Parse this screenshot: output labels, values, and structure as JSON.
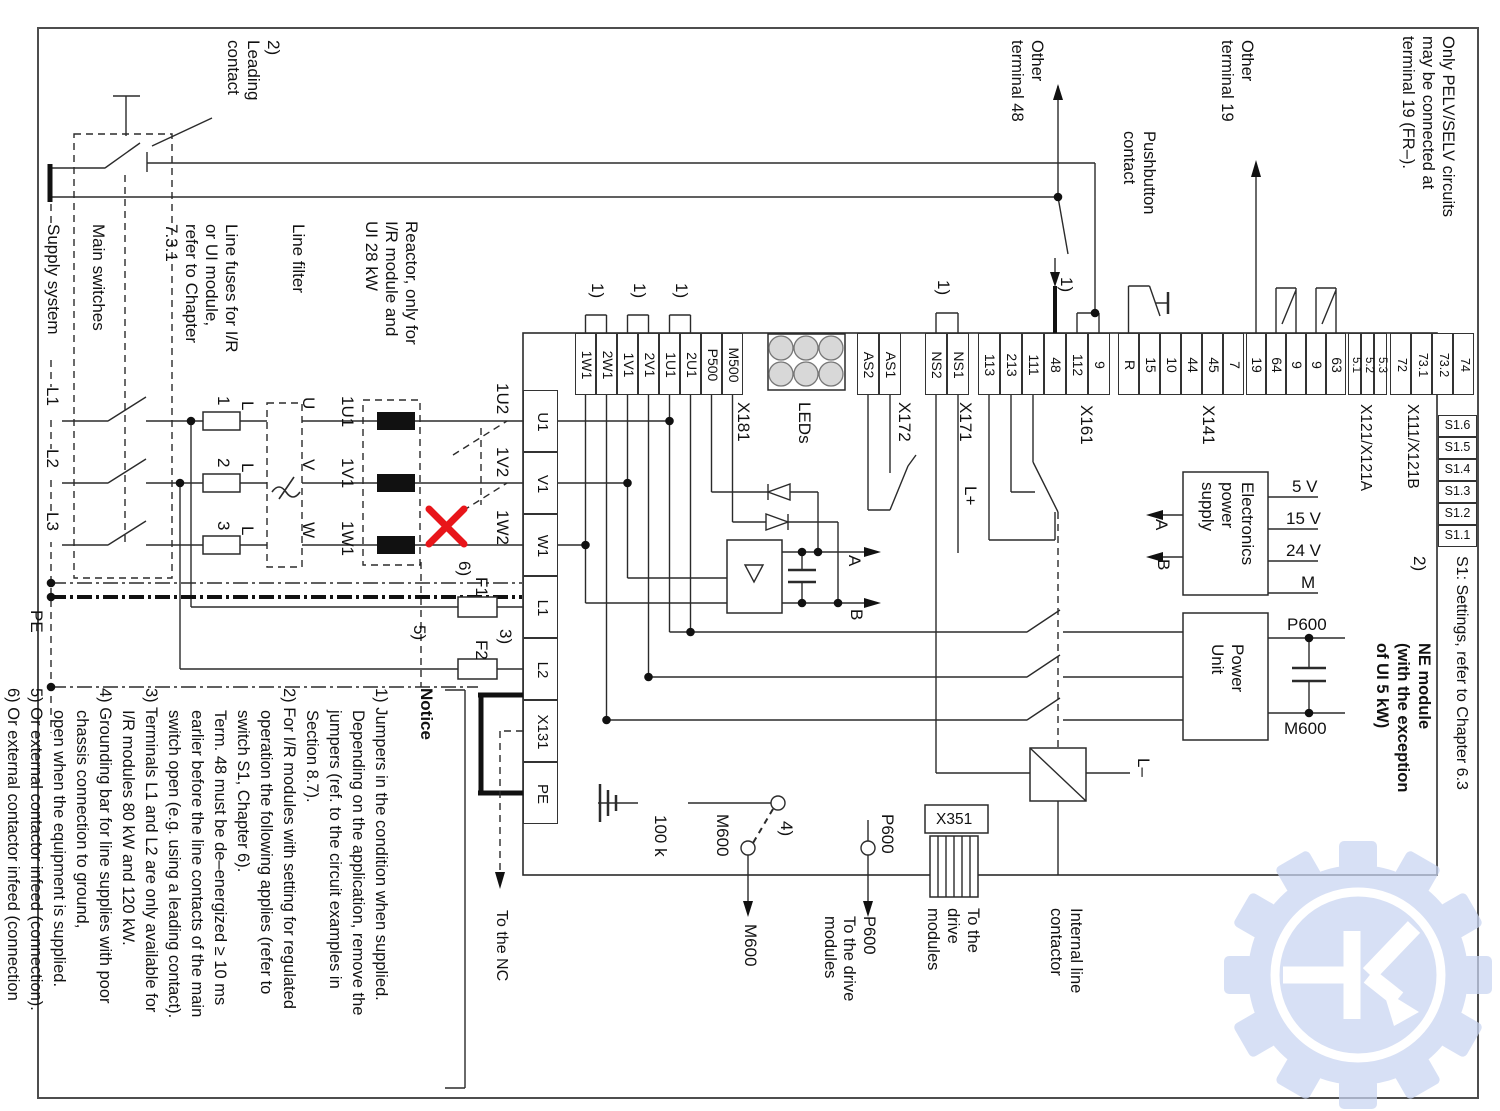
{
  "notice": {
    "header": "Notice",
    "items": [
      "1) Jumpers in the condition when supplied.\nDepending on the application, remove the\njumpers (ref. to the circuit examples in\nSection 8.7).",
      "2) For I/R modules with setting for regulated\noperation the following applies (refer to\nswitch S1, Chapter 6).\nTerm. 48 must be de–energized ≥  10 ms\nearlier before the line contacts of the main\nswitch open (e.g. using a leading contact).",
      "3) Terminals L1 and L2 are only available for\nI/R modules 80 kW and 120 kW.",
      "4) Grounding bar for line supplies with poor\nchassis connection to ground,\nopen when the equipment is supplied.",
      "5) Or external contactor infeed (connection).",
      "6) Or external contactor infeed (connection\nnot permitted)."
    ]
  },
  "s1": {
    "x": 1438,
    "y0": 415,
    "w": 39,
    "h": 22,
    "items": [
      "S1.6",
      "S1.5",
      "S1.4",
      "S1.3",
      "S1.2",
      "S1.1"
    ]
  },
  "terminal_groups": [
    {
      "name": "x181-strip",
      "x0": 575,
      "y0": 333,
      "bw": 21,
      "bh": 62,
      "items": [
        "1W1",
        "2W1",
        "1V1",
        "2V1",
        "1U1",
        "2U1",
        "P500",
        "M500"
      ],
      "fs": 14
    },
    {
      "name": "x172-strip",
      "x0": 857,
      "y0": 333,
      "bw": 22,
      "bh": 62,
      "items": [
        "AS2",
        "AS1"
      ],
      "fs": 14
    },
    {
      "name": "x171-strip",
      "x0": 925,
      "y0": 333,
      "bw": 22,
      "bh": 62,
      "items": [
        "NS2",
        "NS1"
      ],
      "fs": 14
    },
    {
      "name": "x161-strip",
      "x0": 978,
      "y0": 333,
      "bw": 22,
      "bh": 62,
      "items": [
        "113",
        "213",
        "111",
        "48",
        "112",
        "9"
      ],
      "fs": 14
    },
    {
      "name": "x141-strip",
      "x0": 1118,
      "y0": 333,
      "bw": 21,
      "bh": 62,
      "items": [
        "R",
        "15",
        "10",
        "44",
        "45",
        "7"
      ],
      "fs": 14
    },
    {
      "name": "x121a-strip",
      "x0": 1246,
      "y0": 333,
      "bw": 20,
      "bh": 62,
      "items": [
        "19",
        "64",
        "9",
        "9",
        "63"
      ],
      "fs": 14
    },
    {
      "name": "x121a2-strip",
      "x0": 1348,
      "y0": 333,
      "bw": 13,
      "bh": 62,
      "items": [
        "5.1",
        "5.2",
        "5.3"
      ],
      "fs": 11.5
    },
    {
      "name": "x111-strip",
      "x0": 1390,
      "y0": 333,
      "bw": 21,
      "bh": 62,
      "items": [
        "72",
        "73.1",
        "73.2",
        "74"
      ],
      "fs": 12.5
    },
    {
      "name": "module-left",
      "vert": true,
      "x0": 523,
      "y0": 390,
      "bw": 35,
      "bh": 62,
      "items": [
        "U1",
        "V1",
        "W1",
        "L1",
        "L2",
        "X131",
        "PE"
      ],
      "fs": 15
    }
  ],
  "labels": [
    {
      "name": "leading-contact-note",
      "text": "2)\nLeading\ncontact",
      "x": 283,
      "y": 40,
      "w": 82
    },
    {
      "name": "supply-system",
      "text": "Supply system",
      "x": 63,
      "y": 224,
      "w": 132,
      "bg": 1
    },
    {
      "name": "main-switches",
      "text": "Main switches",
      "x": 108,
      "y": 224,
      "w": 132
    },
    {
      "name": "line-fuses-note",
      "text": "Line fuses for I/R\nor UI module,\nrefer to Chapter\n7.3.1",
      "x": 241,
      "y": 224,
      "w": 160
    },
    {
      "name": "line-filter",
      "text": "Line filter",
      "x": 308,
      "y": 224,
      "w": 100
    },
    {
      "name": "reactor-note",
      "text": "Reactor, only for\nI/R module and\nUI 28 kW",
      "x": 421,
      "y": 221,
      "w": 160
    },
    {
      "name": "phase-l1",
      "text": "L1",
      "x": 62,
      "y": 387,
      "w": 30,
      "bg": 1
    },
    {
      "name": "phase-l2",
      "text": "L2",
      "x": 62,
      "y": 449,
      "w": 30,
      "bg": 1
    },
    {
      "name": "phase-l3",
      "text": "L3",
      "x": 62,
      "y": 512,
      "w": 30,
      "bg": 1
    },
    {
      "name": "pe-label",
      "text": "PE",
      "x": 46,
      "y": 610,
      "w": 34
    },
    {
      "name": "fuse-1",
      "text": "1",
      "x": 233,
      "y": 396,
      "w": 16
    },
    {
      "name": "fuse-2",
      "text": "2",
      "x": 233,
      "y": 458,
      "w": 16
    },
    {
      "name": "fuse-3",
      "text": "3",
      "x": 233,
      "y": 521,
      "w": 16
    },
    {
      "name": "fuse-l1",
      "text": "L",
      "x": 257,
      "y": 401,
      "w": 16
    },
    {
      "name": "fuse-l2",
      "text": "L",
      "x": 257,
      "y": 463,
      "w": 16
    },
    {
      "name": "fuse-l3",
      "text": "L",
      "x": 257,
      "y": 526,
      "w": 16
    },
    {
      "name": "filter-u",
      "text": "U",
      "x": 318,
      "y": 397,
      "w": 16
    },
    {
      "name": "filter-v",
      "text": "V",
      "x": 318,
      "y": 459,
      "w": 16
    },
    {
      "name": "filter-w",
      "text": "W",
      "x": 318,
      "y": 522,
      "w": 16
    },
    {
      "name": "reactor-1u1",
      "text": "1U1",
      "x": 357,
      "y": 396,
      "w": 38
    },
    {
      "name": "reactor-1v1",
      "text": "1V1",
      "x": 357,
      "y": 458,
      "w": 38
    },
    {
      "name": "reactor-1w1",
      "text": "1W1",
      "x": 357,
      "y": 521,
      "w": 38
    },
    {
      "name": "out-1u2",
      "text": "1U2",
      "x": 512,
      "y": 383,
      "w": 40
    },
    {
      "name": "out-1v2",
      "text": "1V2",
      "x": 512,
      "y": 447,
      "w": 40
    },
    {
      "name": "out-1w2",
      "text": "1W2",
      "x": 512,
      "y": 510,
      "w": 40
    },
    {
      "name": "ref-6",
      "text": "6)",
      "x": 474,
      "y": 561,
      "w": 24
    },
    {
      "name": "fuse-f1",
      "text": "F1",
      "x": 491,
      "y": 577,
      "w": 22
    },
    {
      "name": "ref-5",
      "text": "5)",
      "x": 429,
      "y": 625,
      "w": 24
    },
    {
      "name": "ref-3",
      "text": "3)",
      "x": 515,
      "y": 629,
      "w": 24
    },
    {
      "name": "fuse-f2",
      "text": "F2",
      "x": 491,
      "y": 640,
      "w": 22
    },
    {
      "name": "to-the-nc",
      "text": "To the NC",
      "x": 511,
      "y": 910,
      "w": 100,
      "fs": 16
    },
    {
      "name": "resistor-100k",
      "text": "100 k",
      "x": 670,
      "y": 815,
      "w": 58
    },
    {
      "name": "m600-tap",
      "text": "M600",
      "x": 732,
      "y": 814,
      "w": 56
    },
    {
      "name": "ref-4",
      "text": "4)",
      "x": 796,
      "y": 821,
      "w": 26
    },
    {
      "name": "m600-out",
      "text": "M600",
      "x": 760,
      "y": 924,
      "w": 62
    },
    {
      "name": "p600-tap",
      "text": "P600",
      "x": 897,
      "y": 814,
      "w": 52
    },
    {
      "name": "p600-out",
      "text": "P600\nTo the drive\nmodules",
      "x": 878,
      "y": 916,
      "w": 104,
      "lh": 19.5,
      "fs": 16.5
    },
    {
      "name": "x351-out",
      "text": "To the\ndrive\nmodules",
      "x": 983,
      "y": 908,
      "w": 96,
      "fs": 16.5
    },
    {
      "name": "internal-line-contactor",
      "text": "Internal line\ncontactor",
      "x": 1086,
      "y": 908,
      "w": 110,
      "fs": 16.5
    },
    {
      "name": "x181",
      "text": "X181",
      "x": 753,
      "y": 402,
      "w": 58
    },
    {
      "name": "leds-label",
      "text": "LEDs",
      "x": 814,
      "y": 402,
      "w": 58
    },
    {
      "name": "x172",
      "text": "X172",
      "x": 914,
      "y": 402,
      "w": 58
    },
    {
      "name": "x171",
      "text": "X171",
      "x": 975,
      "y": 402,
      "w": 58
    },
    {
      "name": "l-plus",
      "text": "L+",
      "x": 980,
      "y": 486,
      "w": 34
    },
    {
      "name": "x161",
      "text": "X161",
      "x": 1096,
      "y": 405,
      "w": 58
    },
    {
      "name": "x141",
      "text": "X141",
      "x": 1218,
      "y": 405,
      "w": 58
    },
    {
      "name": "x121-x121a",
      "text": "X121/X121A",
      "x": 1375,
      "y": 404,
      "w": 118,
      "fs": 15.5
    },
    {
      "name": "x111-x121b",
      "text": "X111/X121B",
      "x": 1422,
      "y": 404,
      "w": 118,
      "fs": 15.5
    },
    {
      "name": "other-terminal-48",
      "text": "Other\nterminal 48",
      "x": 1047,
      "y": 40,
      "w": 104,
      "fs": 16.5
    },
    {
      "name": "pushbutton-contact",
      "text": "Pushbutton\ncontact",
      "x": 1159,
      "y": 131,
      "w": 112,
      "fs": 16.5
    },
    {
      "name": "other-terminal-19",
      "text": "Other\nterminal 19",
      "x": 1257,
      "y": 40,
      "w": 104,
      "fs": 16.5
    },
    {
      "name": "pelv-note",
      "text": "Only PELV/SELV circuits\nmay be connected at\nterminal 19 (FR–).",
      "x": 1458,
      "y": 36,
      "w": 230,
      "fs": 16.5
    },
    {
      "name": "rect-a",
      "text": "A",
      "x": 864,
      "y": 555,
      "w": 20
    },
    {
      "name": "rect-b",
      "text": "B",
      "x": 866,
      "y": 609,
      "w": 20
    },
    {
      "name": "eps-a",
      "text": "A",
      "x": 1171,
      "y": 519,
      "w": 20
    },
    {
      "name": "eps-b",
      "text": "B",
      "x": 1173,
      "y": 559,
      "w": 20
    },
    {
      "name": "electronics-power-supply",
      "text": "Electronics\npower\nsupply",
      "x": 1257,
      "y": 482,
      "w": 100
    },
    {
      "name": "power-unit",
      "text": "Power\nUnit",
      "x": 1247,
      "y": 644,
      "w": 74
    },
    {
      "name": "s1-settings-note",
      "text": "S1: Settings, refer to Chapter 6.3",
      "x": 1471,
      "y": 556,
      "w": 300,
      "fs": 16
    },
    {
      "name": "ref-2-right",
      "text": "2)",
      "x": 1429,
      "y": 556,
      "w": 26
    },
    {
      "name": "ne-module-title",
      "text": "NE module\n(with the exception\nof UI 5 kW)",
      "x": 1434,
      "y": 643,
      "w": 182,
      "lh": 21,
      "fs": 16.5,
      "b": 1
    },
    {
      "name": "jumper-1a",
      "text": "1)",
      "x": 607,
      "y": 283,
      "w": 26
    },
    {
      "name": "jumper-1b",
      "text": "1)",
      "x": 649,
      "y": 283,
      "w": 26
    },
    {
      "name": "jumper-1c",
      "text": "1)",
      "x": 691,
      "y": 283,
      "w": 26
    },
    {
      "name": "jumper-1-ns",
      "text": "1)",
      "x": 953,
      "y": 280,
      "w": 26
    },
    {
      "name": "jumper-1-112",
      "text": "1)",
      "x": 1076,
      "y": 277,
      "w": 28
    },
    {
      "name": "l-minus",
      "text": "L–",
      "x": 1153,
      "y": 758,
      "w": 36
    },
    {
      "name": "volt-5",
      "text": "5 V",
      "x": 1292,
      "y": 477,
      "h": 1
    },
    {
      "name": "volt-15",
      "text": "15 V",
      "x": 1286,
      "y": 509,
      "h": 1
    },
    {
      "name": "volt-24",
      "text": "24 V",
      "x": 1286,
      "y": 541,
      "h": 1
    },
    {
      "name": "volt-m",
      "text": "M",
      "x": 1301,
      "y": 573,
      "h": 1
    },
    {
      "name": "p600-dclink",
      "text": "P600",
      "x": 1287,
      "y": 615,
      "h": 1
    },
    {
      "name": "m600-dclink",
      "text": "M600",
      "x": 1284,
      "y": 719,
      "h": 1
    },
    {
      "name": "x351",
      "text": "X351",
      "x": 936,
      "y": 810,
      "h": 1,
      "fs": 15.5
    }
  ],
  "colors": {
    "wire": "#2b2b2b",
    "error_cross": "#e8151a",
    "watermark": "#c9d5f2",
    "led_fill": "#d8d8d8"
  }
}
